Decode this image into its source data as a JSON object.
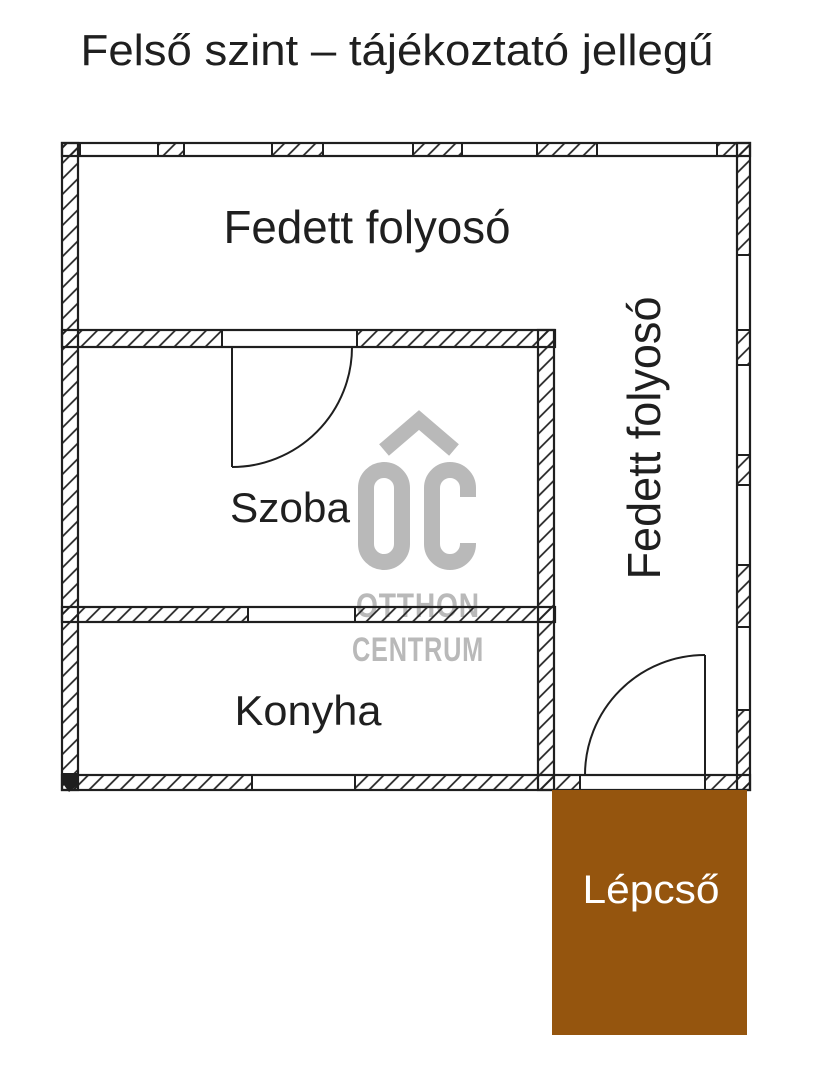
{
  "title": "Felső szint – tájékoztató jellegű",
  "plan": {
    "rooms": {
      "corridor_top": "Fedett folyosó",
      "corridor_right": "Fedett folyosó",
      "room": "Szoba",
      "kitchen": "Konyha",
      "stairs": "Lépcső"
    },
    "colors": {
      "wall_ink": "#1f1f1f",
      "stairs_fill": "#95550e",
      "stairs_text": "#ffffff",
      "watermark_gray": "#b9b9b9"
    }
  },
  "watermark": {
    "monogram": "OC",
    "roof_icon": "roof-chevron",
    "line1": "OTTHON",
    "line2": "CENTRUM"
  }
}
